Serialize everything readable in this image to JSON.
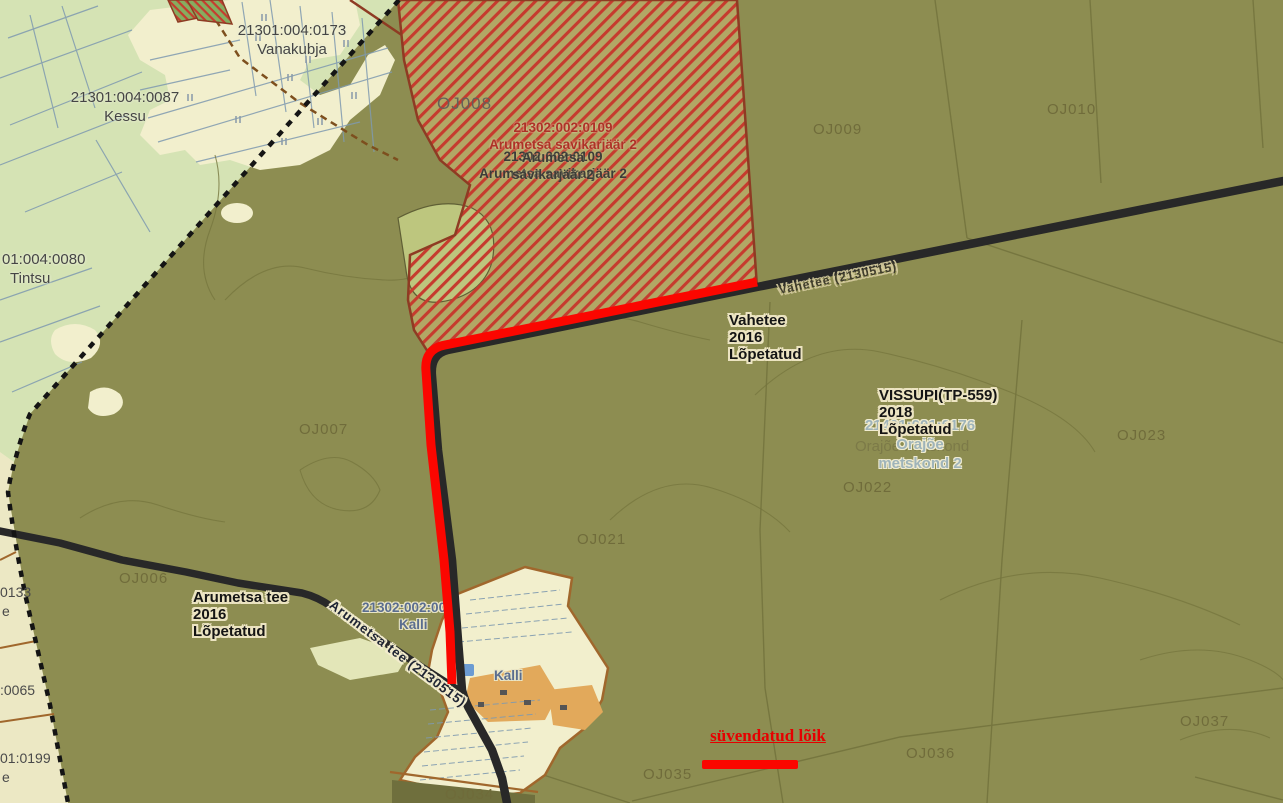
{
  "colors": {
    "olive": "#8d8d51",
    "lightgreen": "#d5e3b4",
    "cream": "#f2efcd",
    "creamstrip": "#ece8c4",
    "hatchbase": "#b2a765",
    "hatchstripe": "#c63b2e",
    "hatchborder": "#8e3b23",
    "clearing": "#bdc67e",
    "road": "#282828",
    "red": "#fb0600",
    "boundary": "#141414",
    "browndash": "#7d4f1e",
    "villageborder": "#a0672c",
    "building": "#e2a95b",
    "pond": "#6b9bd2",
    "slate": "#7f9ab0",
    "parcelline": "#74743e",
    "contour": "#77773f",
    "darkstrip": "#6f6f3d",
    "orchardgreen": "#86ad60"
  },
  "labels": {
    "oj006": "OJ006",
    "oj007": "OJ007",
    "oj008": "OJ008",
    "oj009": "OJ009",
    "oj010": "OJ010",
    "oj021": "OJ021",
    "oj022": "OJ022",
    "oj023": "OJ023",
    "oj034": "OJ034",
    "oj035": "OJ035",
    "oj036": "OJ036",
    "oj037": "OJ037"
  },
  "cadastral": {
    "vanakubja_no": "21301:004:0173",
    "vanakubja_name": "Vanakubja",
    "kessu_no": "21301:004:0087",
    "kessu_name": "Kessu",
    "tintsu_no": "01:004:0080",
    "tintsu_name": "Tintsu",
    "edge_frag_1": "0133",
    "edge_frag_2": "e",
    "edge_frag_3": ":0065",
    "edge_frag_4": "01:0199",
    "edge_frag_5": "e",
    "kalli_no": "21302:002:00",
    "kalli_name": "Kalli",
    "kalli_name_2": "Kalli",
    "orajoe_no": "21401:001:0176",
    "orajoe_line2": "Orajõe",
    "orajoe_line3": "metskond 2",
    "orajoe_bg": "Orajõe metskond"
  },
  "quarry": {
    "red_no": "21302:002:0109",
    "red_name": "Arumetsa savikarjäär 2",
    "dark_no": "21302:002:0109",
    "dark_name": "Arumetsa savikarjäär 2",
    "dark2_line1": "Arumetsa",
    "dark2_line2": "savikarjäär 2"
  },
  "annotations": {
    "vahetee": [
      "Vahetee",
      "2016",
      "Lõpetatud"
    ],
    "vissupi": [
      "VISSUPI(TP-559)",
      "2018",
      "Lõpetatud"
    ],
    "arumetsa": [
      "Arumetsa tee",
      "2016",
      "Lõpetatud"
    ]
  },
  "roads": {
    "arumetsa_label": "Arumetsa tee (2130515)",
    "vahetee_label": "Vahetee (2130515)"
  },
  "legend": {
    "highlight": "süvendatud lõik"
  }
}
